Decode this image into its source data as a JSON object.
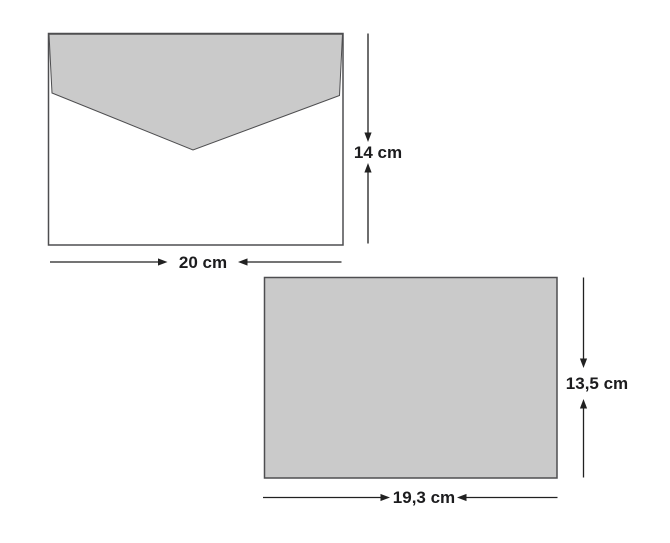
{
  "diagram": {
    "description": "Envelope and card with measured dimensions",
    "background": "#ffffff",
    "colors": {
      "shape_fill": "#cacaca",
      "envelope_body_fill": "#ffffff",
      "shape_outline": "#4e4e50",
      "line": "#212121",
      "text": "#1c1c1e"
    },
    "envelope": {
      "name": "envelope",
      "width_label": "20 cm",
      "height_label": "14 cm"
    },
    "card": {
      "name": "card",
      "width_label": "19,3 cm",
      "height_label": "13,5 cm"
    }
  }
}
